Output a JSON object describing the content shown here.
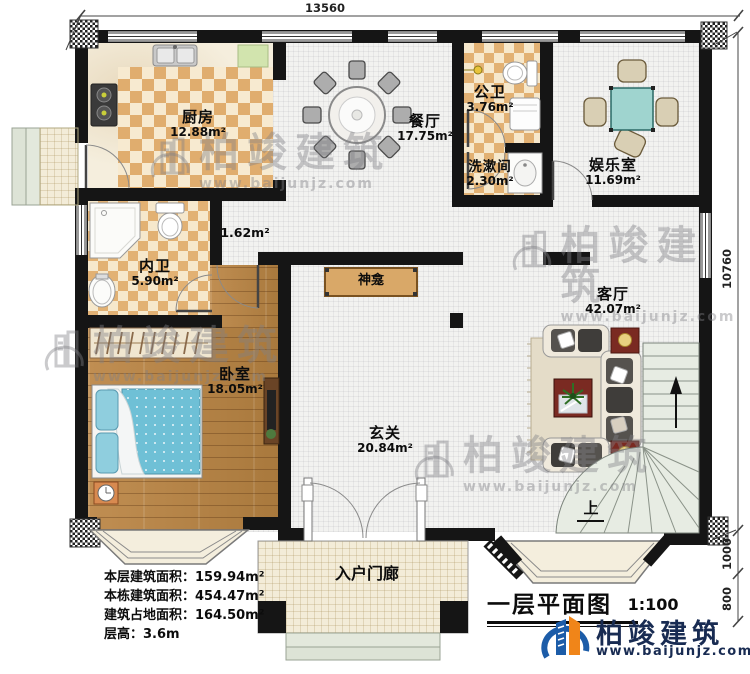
{
  "plan": {
    "title": "一层平面图",
    "scale": "1:100"
  },
  "dimensions": {
    "top_width": "13560",
    "right_height": "10760",
    "right_mid": "1000",
    "right_bottom": "800"
  },
  "rooms": {
    "kitchen": {
      "name": "厨房",
      "area": "12.88m²"
    },
    "dining": {
      "name": "餐厅",
      "area": "17.75m²"
    },
    "public_bath": {
      "name": "公卫",
      "area": "3.76m²"
    },
    "washroom": {
      "name": "洗漱间",
      "area": "2.30m²"
    },
    "entertainment": {
      "name": "娱乐室",
      "area": "11.69m²"
    },
    "private_bath": {
      "name": "内卫",
      "area": "5.90m²"
    },
    "corridor": {
      "area": "1.62m²"
    },
    "bedroom": {
      "name": "卧室",
      "area": "18.05m²"
    },
    "shrine": {
      "name": "神龛"
    },
    "foyer": {
      "name": "玄关",
      "area": "20.84m²"
    },
    "living": {
      "name": "客厅",
      "area": "42.07m²"
    },
    "porch": {
      "name": "入户门廊"
    }
  },
  "stairs": {
    "up_label": "上"
  },
  "info_block": {
    "rows": [
      "本层建筑面积：159.94m²",
      "本栋建筑面积：454.47m²",
      "建筑占地面积：164.50m²",
      "层高：3.6m"
    ]
  },
  "branding": {
    "company": "柏竣建筑",
    "website": "www.baijunjz.com"
  },
  "colors": {
    "wall": "#151515",
    "checker_dark": "#e0ad6e",
    "checker_light": "#f7ead0",
    "wood": "#b5834a",
    "mattress_blue": "#6fc0d6",
    "table_teal": "#9fd4cf",
    "accent_red": "#7a2a22",
    "stairs_fill": "#e7ece3",
    "logo_blue": "#1c5ca8",
    "logo_orange": "#f08519"
  }
}
